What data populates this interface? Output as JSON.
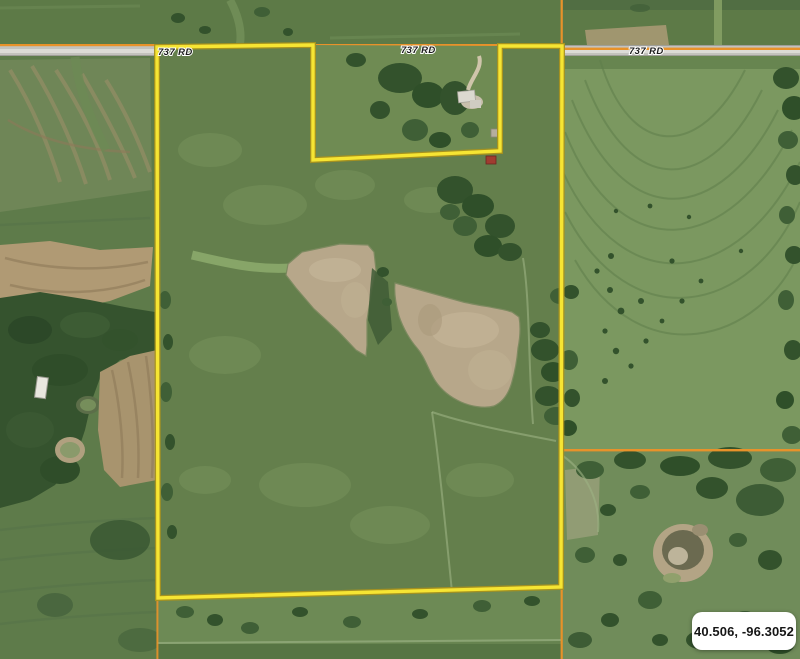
{
  "map": {
    "view": "aerial-imagery-parcel-view",
    "road_labels": [
      {
        "text": "737 RD"
      },
      {
        "text": "737 RD"
      },
      {
        "text": "737 RD"
      }
    ],
    "tooltip": {
      "coordinates": "40.506, -96.3052"
    },
    "parcel": {
      "outline_points": "157,47 313,45 313,160 500,151 500,46 562,46 561,587 158,598"
    },
    "colors": {
      "parcel_outline": "#f6e533",
      "parcel_outline_edge": "#a8921e",
      "section_line": "#e8922a",
      "road_surface": "#c3c2bd",
      "road_stripe": "#e0dfdb",
      "base_field_green": "#66834f",
      "pasture_green": "#647f4c",
      "contour_field_green": "#7b9860",
      "shrubland_green": "#708c5a",
      "pond_tan": "#b7a78a",
      "tree_dark": "#33522c",
      "tooltip_bg": "#ffffff",
      "tooltip_text": "#161616"
    }
  }
}
